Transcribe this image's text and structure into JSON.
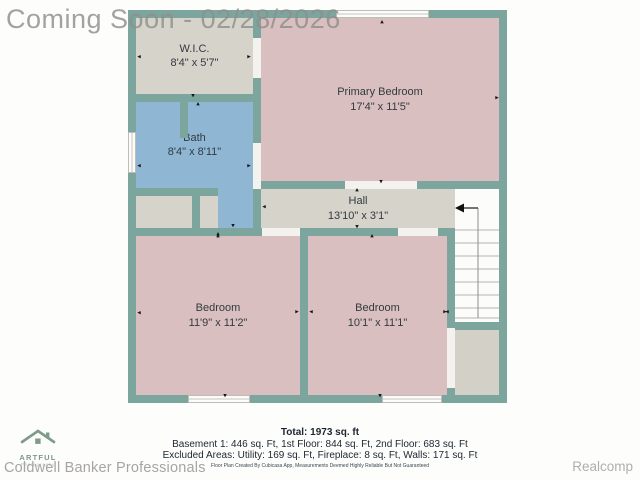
{
  "watermark": "Coming Soon - 02/28/2026",
  "plan": {
    "rooms": [
      {
        "name": "W.I.C.",
        "dims": "8'4\" x 5'7\""
      },
      {
        "name": "Primary Bedroom",
        "dims": "17'4\" x 11'5\""
      },
      {
        "name": "Bath",
        "dims": "8'4\" x 8'11\""
      },
      {
        "name": "Hall",
        "dims": "13'10\" x 3'1\""
      },
      {
        "name": "Bedroom",
        "dims": "11'9\" x 11'2\""
      },
      {
        "name": "Bedroom",
        "dims": "10'1\" x 11'1\""
      }
    ]
  },
  "summary": {
    "total": "Total: 1973 sq. ft",
    "floors": "Basement 1: 446 sq. Ft, 1st Floor: 844 sq. Ft, 2nd Floor: 683 sq. Ft",
    "excluded": "Excluded Areas: Utility: 169 sq. Ft, Fireplace: 8 sq. Ft, Walls: 171 sq. Ft",
    "disclaimer": "Floor Plan Created By Cubicasa App, Measurements Deemed Highly Reliable But Not Guaranteed"
  },
  "branding": {
    "photographer_name": "ARTFUL",
    "photographer_subtitle": "Photography",
    "brokerage": "Coldwell Banker Professionals",
    "mls": "Realcomp"
  },
  "colors": {
    "wall": "#7CA59E",
    "room_gray": "#D5D3CA",
    "room_pink": "#D9BFBF",
    "room_blue": "#8FB7D4"
  }
}
